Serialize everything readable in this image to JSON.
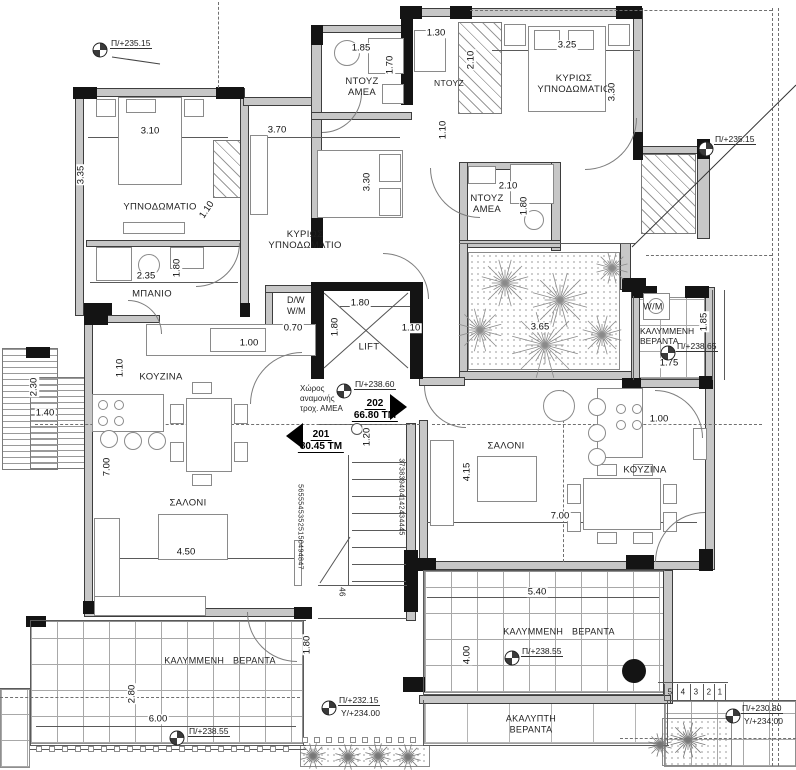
{
  "plan": {
    "rooms": {
      "bedroom_left": "ΥΠΝΟΔΩΜΑΤΙΟ",
      "master_bedroom_center": "ΚΥΡΙΩΣ ΥΠΝΟΔΩΜΑΤΙΟ",
      "master_bedroom_right": "ΚΥΡΙΩΣ ΥΠΝΟΔΩΜΑΤΙΟ",
      "shower_amea_top": "ΝΤΟΥΖ ΑΜΕΑ",
      "shower_top_right": "ΝΤΟΥΖ",
      "shower_amea_mid": "ΝΤΟΥΖ ΑΜΕΑ",
      "bathroom_left": "ΜΠΑΝΙΟ",
      "kitchen_left": "ΚΟΥΖΙΝΑ",
      "kitchen_right": "ΚΟΥΖΙΝΑ",
      "living_left": "ΣΑΛΟΝΙ",
      "living_right": "ΣΑΛΟΝΙ",
      "laundry_right": "W/M",
      "laundry_center": "D/W W/M",
      "lift": "LIFT",
      "wheelchair_waiting": "Χώρος αναμονής τροχ. ΑΜΕΑ",
      "covered_veranda_right": "ΚΑΛΥΜΜΕΝΗ ΒΕΡΑΝΤΑ",
      "covered_veranda_bottom_left": "ΚΑΛΥΜΜΕΝΗ ΒΕΡΑΝΤΑ",
      "covered_veranda_bottom_right": "ΚΑΛΥΜΜΕΝΗ ΒΕΡΑΝΤΑ",
      "uncovered_veranda": "ΑΚΑΛΥΠΤΗ ΒΕΡΑΝΤΑ"
    },
    "apartments": [
      {
        "number": "201",
        "area": "80.45 ΤΜ"
      },
      {
        "number": "202",
        "area": "66.80 ΤΜ"
      }
    ],
    "levels": {
      "tl": "Π/+235.15",
      "tr": "Π/+235.15",
      "lobby": "Π/+238.60",
      "vr": "Π/+238.65",
      "vbl": "Π/+238.55",
      "vbr": "Π/+238.55",
      "g1p": "Π/+232.15",
      "g1y": "Υ/+234.00",
      "g2p": "Π/+230.80",
      "g2y": "Υ/+234.00"
    },
    "dims": {
      "w_bed_left": "3.10",
      "h_bed_left": "3.35",
      "d_bed_left": "1.10",
      "w_master_c": "3.70",
      "h_master_c": "3.30",
      "w_shower_amea_top": "1.85",
      "h_shower_amea_top": "1.70",
      "w_shower_tr": "1.30",
      "h_shower_tr": "2.10",
      "w_master_r": "3.25",
      "h_master_r": "3.30",
      "h_hall_tr": "1.10",
      "w_shower_mid": "2.10",
      "h_shower_mid": "1.80",
      "w_bath": "2.35",
      "h_bath": "1.80",
      "w_lift": "1.80",
      "h_lift": "1.80",
      "w_dw": "0.70",
      "w_kitchen_pass": "1.00",
      "w_hall_c": "1.10",
      "w_planter": "3.65",
      "h_ver_r": "1.85",
      "w_ver_r": "1.75",
      "h_kitchen_l": "1.10",
      "h_left_ext": "2.30",
      "w_left_ext": "1.40",
      "h_living_l": "7.00",
      "w_living_l": "4.50",
      "h_lobby": "1.20",
      "h_living_r": "4.15",
      "w_kitchen_r": "1.00",
      "w_living_r": "7.00",
      "w_ver_br": "5.40",
      "h_ver_br": "4.00",
      "h_ver_bc": "1.80",
      "h_ver_bl": "2.80",
      "w_ver_bl": "6.00"
    },
    "stairs": {
      "flight_upper": "373839404142434445",
      "flight_lower": "56555453525150494847",
      "step_46": "46",
      "ext_steps": [
        "5",
        "4",
        "3",
        "2",
        "1"
      ]
    }
  }
}
